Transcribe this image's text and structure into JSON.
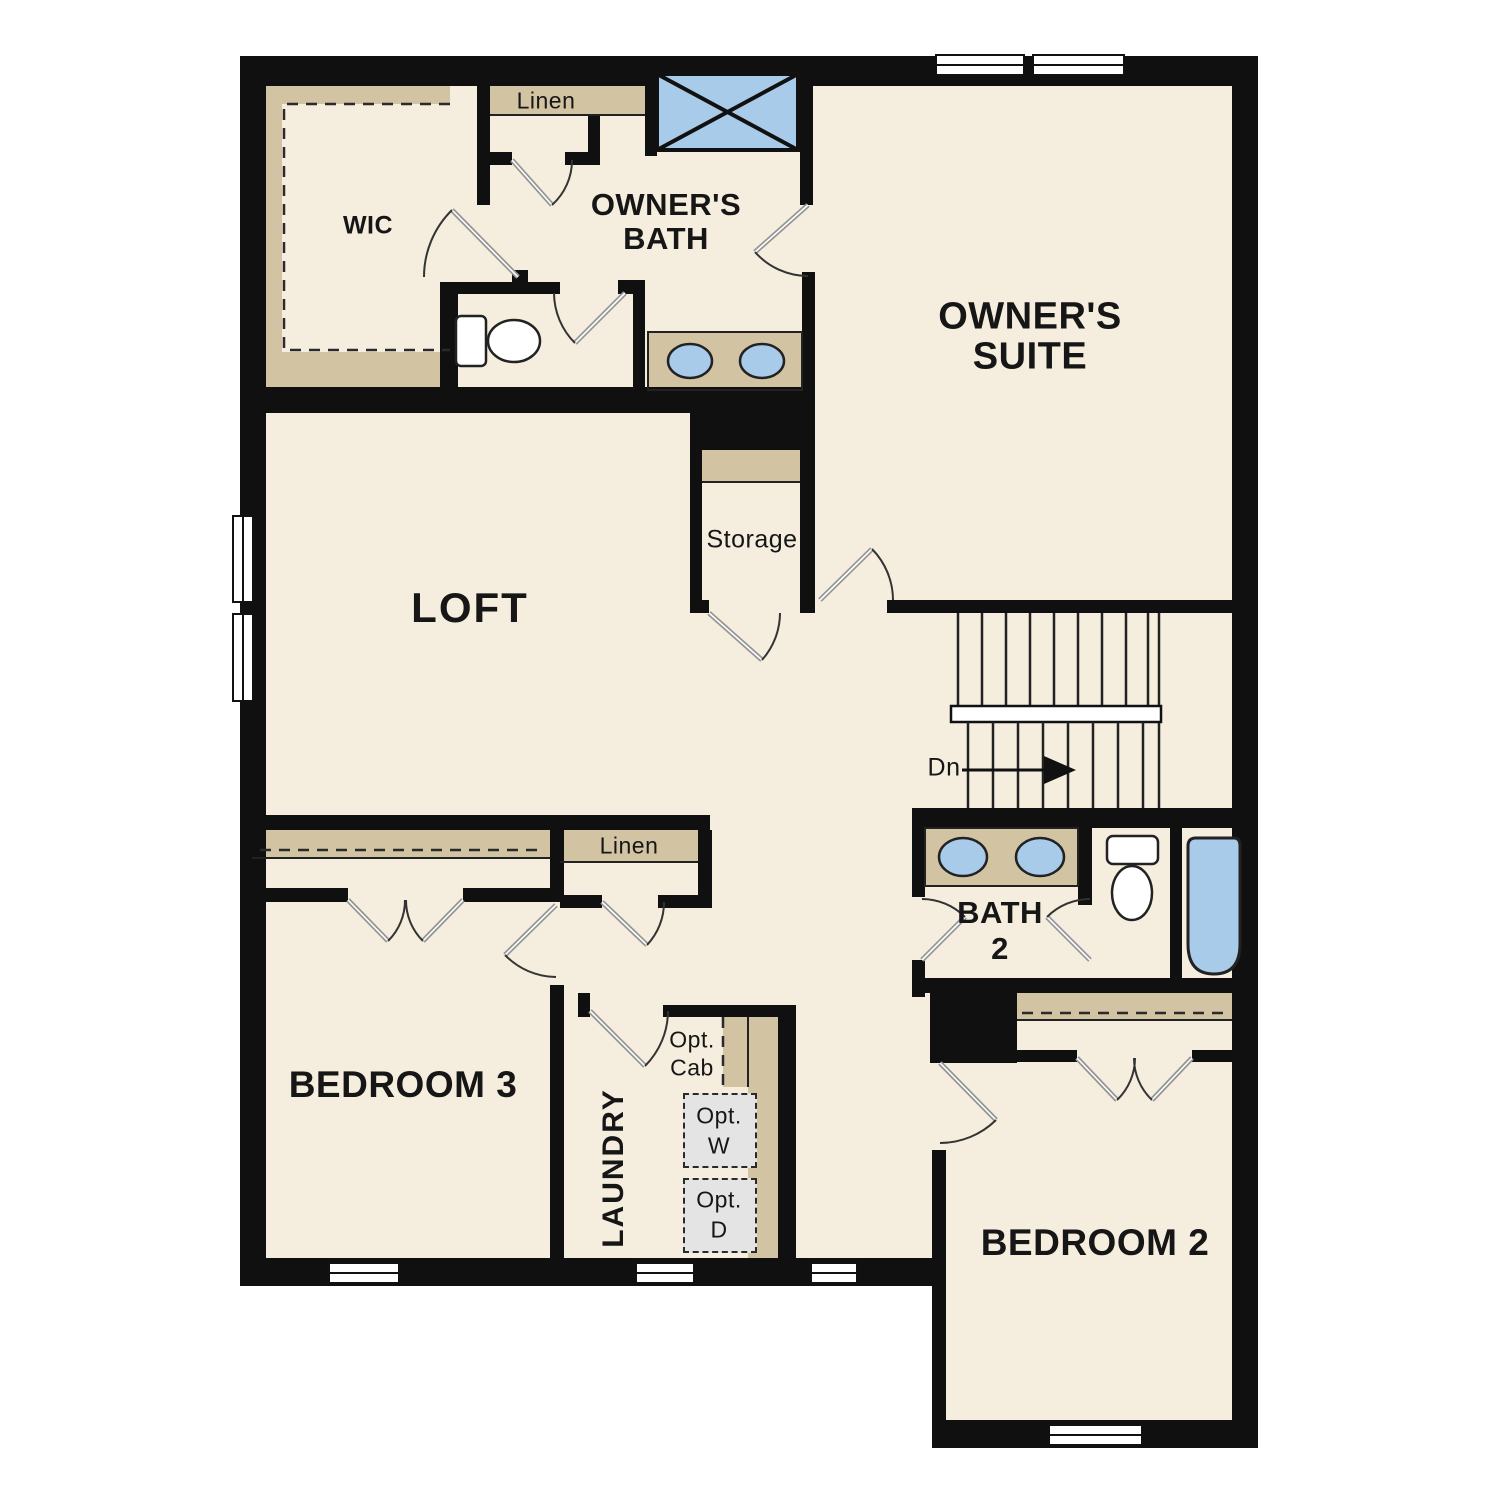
{
  "plan": {
    "rooms": {
      "wic": "WIC",
      "owners_bath_line1": "OWNER'S",
      "owners_bath_line2": "BATH",
      "owners_suite_line1": "OWNER'S",
      "owners_suite_line2": "SUITE",
      "loft": "LOFT",
      "storage": "Storage",
      "bath2_line1": "BATH",
      "bath2_line2": "2",
      "bedroom3": "BEDROOM 3",
      "laundry": "LAUNDRY",
      "bedroom2": "BEDROOM 2"
    },
    "closets": {
      "linen_top": "Linen",
      "linen_hall": "Linen"
    },
    "stairs": {
      "direction_label": "Dn"
    },
    "laundry_options": {
      "cab_line1": "Opt.",
      "cab_line2": "Cab",
      "washer_line1": "Opt.",
      "washer_line2": "W",
      "dryer_line1": "Opt.",
      "dryer_line2": "D"
    },
    "colors": {
      "wall": "#101010",
      "floor": "#f5edde",
      "shelf": "#d2c3a3",
      "fixture_blue": "#a9cbea",
      "option_box": "#e4e4e4"
    }
  }
}
